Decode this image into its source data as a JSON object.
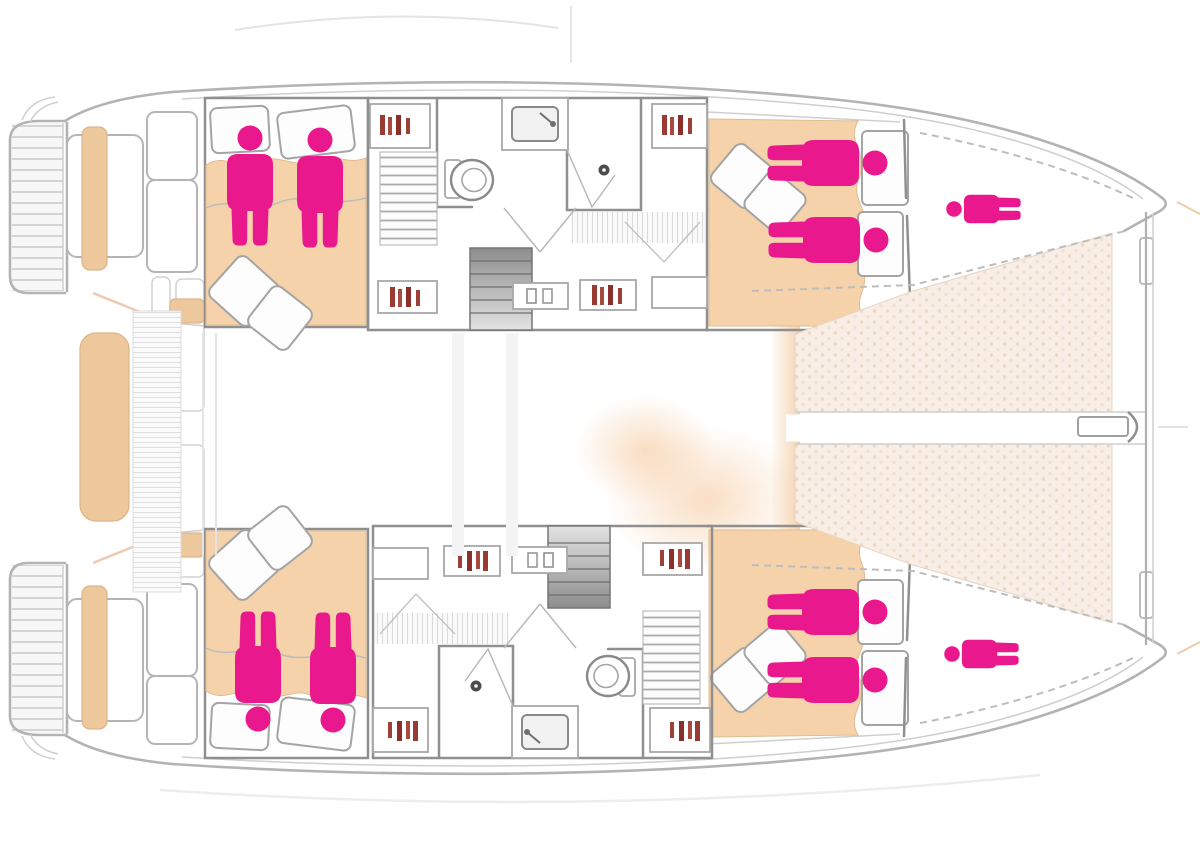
{
  "meta": {
    "title": "Catamaran yacht deck plan",
    "view": "top-down floor plan",
    "bow_direction": "right",
    "stern_direction": "left"
  },
  "colors": {
    "occupant": "#e9188c",
    "hull": "#b3b3b3",
    "wall": "#8f8f8f",
    "wood": "#f5d2a9",
    "bench": "#eec89d",
    "trampoline": "#f8eee6",
    "detail_red": "#993a33",
    "background": "#ffffff"
  },
  "icons": {
    "person-icon-meaning": "berth occupancy (sleeping places)"
  },
  "occupancy": {
    "total_people_shown": 10,
    "double_cabins": 4,
    "single_berths": 2
  },
  "cabins": [
    {
      "id": "port-aft-double-cabin",
      "berth": "double",
      "occupants": 2,
      "icon": "person-standing",
      "rotate": 0,
      "scale": 1,
      "positions": [
        [
          250,
          138
        ],
        [
          320,
          140
        ]
      ]
    },
    {
      "id": "port-forward-double-cabin",
      "berth": "double",
      "occupants": 2,
      "icon": "person-lying",
      "rotate": 90,
      "scale": 1,
      "positions": [
        [
          875,
          163
        ],
        [
          876,
          240
        ]
      ]
    },
    {
      "id": "port-forepeak-single-berth",
      "berth": "single",
      "occupants": 1,
      "icon": "person-lying-small",
      "rotate": -90,
      "scale": 0.62,
      "positions": [
        [
          954,
          209
        ]
      ]
    },
    {
      "id": "starboard-aft-double-cabin",
      "berth": "double",
      "occupants": 2,
      "icon": "person-standing-inverted",
      "rotate": 180,
      "scale": 1,
      "positions": [
        [
          258,
          719
        ],
        [
          333,
          720
        ]
      ]
    },
    {
      "id": "starboard-forward-double-cabin",
      "berth": "double",
      "occupants": 2,
      "icon": "person-lying",
      "rotate": 90,
      "scale": 1,
      "positions": [
        [
          875,
          612
        ],
        [
          875,
          680
        ]
      ]
    },
    {
      "id": "starboard-forepeak-single-berth",
      "berth": "single",
      "occupants": 1,
      "icon": "person-lying-small",
      "rotate": -90,
      "scale": 0.62,
      "positions": [
        [
          952,
          654
        ]
      ]
    }
  ],
  "areas": [
    {
      "id": "port-swim-platform"
    },
    {
      "id": "starboard-swim-platform"
    },
    {
      "id": "aft-cockpit"
    },
    {
      "id": "saloon"
    },
    {
      "id": "port-bathroom"
    },
    {
      "id": "starboard-bathroom"
    },
    {
      "id": "companionway-stairs"
    },
    {
      "id": "trampoline"
    },
    {
      "id": "bowsprit"
    },
    {
      "id": "forward-crossbeam"
    }
  ]
}
